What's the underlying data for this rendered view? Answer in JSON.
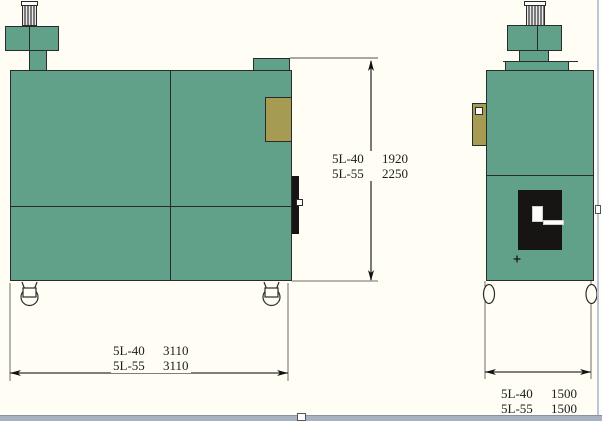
{
  "drawing": {
    "type": "machine-dimension-drawing",
    "models": [
      "5L-40",
      "5L-55"
    ]
  },
  "colors": {
    "machine_green": "#61a189",
    "panel_olive": "#a59b52",
    "outline": "#2b2b2b",
    "background": "#fffdf4",
    "window_bar": "#a8b2c0",
    "window_edge": "#b9c7dc"
  },
  "dimensions": {
    "height": {
      "rows": [
        {
          "model": "5L-40",
          "value": "1920"
        },
        {
          "model": "5L-55",
          "value": "2250"
        }
      ]
    },
    "length": {
      "rows": [
        {
          "model": "5L-40",
          "value": "3110"
        },
        {
          "model": "5L-55",
          "value": "3110"
        }
      ]
    },
    "width": {
      "rows": [
        {
          "model": "5L-40",
          "value": "1500"
        },
        {
          "model": "5L-55",
          "value": "1500"
        }
      ]
    }
  }
}
